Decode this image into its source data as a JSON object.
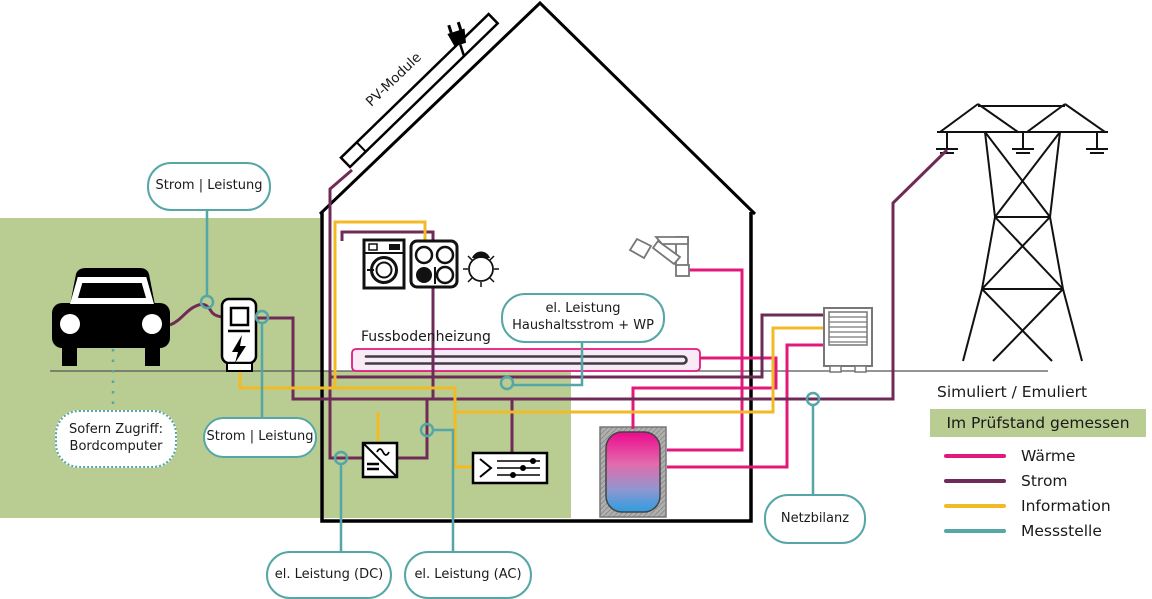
{
  "colors": {
    "waerme": "#e2187d",
    "strom": "#6f2b57",
    "information": "#f2ba24",
    "messstelle": "#55a6a6",
    "test_bench_green": "#b9cc92",
    "floor_heating_fill": "#faeaf5",
    "tank_colors": [
      "#ec0b8e",
      "#e36bac",
      "#8f97cf",
      "#2d9de2"
    ]
  },
  "labels": {
    "pv_module": "PV-Module",
    "fussbodenheizung": "Fussbodenheizung"
  },
  "bubbles": {
    "strom_leistung_top": "Strom | Leistung",
    "strom_leistung_wallbox": "Strom | Leistung",
    "haushalt_line1": "el. Leistung",
    "haushalt_line2": "Haushaltsstrom + WP",
    "el_leistung_dc": "el. Leistung (DC)",
    "el_leistung_ac": "el. Leistung (AC)",
    "netzbilanz": "Netzbilanz",
    "bordcomputer_line1": "Sofern Zugriff:",
    "bordcomputer_line2": "Bordcomputer"
  },
  "legend": {
    "simuliert": "Simuliert / Emuliert",
    "gemessen": "Im Prüfstand gemessen",
    "items": [
      {
        "label": "Wärme",
        "color": "#e2187d"
      },
      {
        "label": "Strom",
        "color": "#6f2b57"
      },
      {
        "label": "Information",
        "color": "#f2ba24"
      },
      {
        "label": "Messstelle",
        "color": "#55a6a6"
      }
    ]
  }
}
